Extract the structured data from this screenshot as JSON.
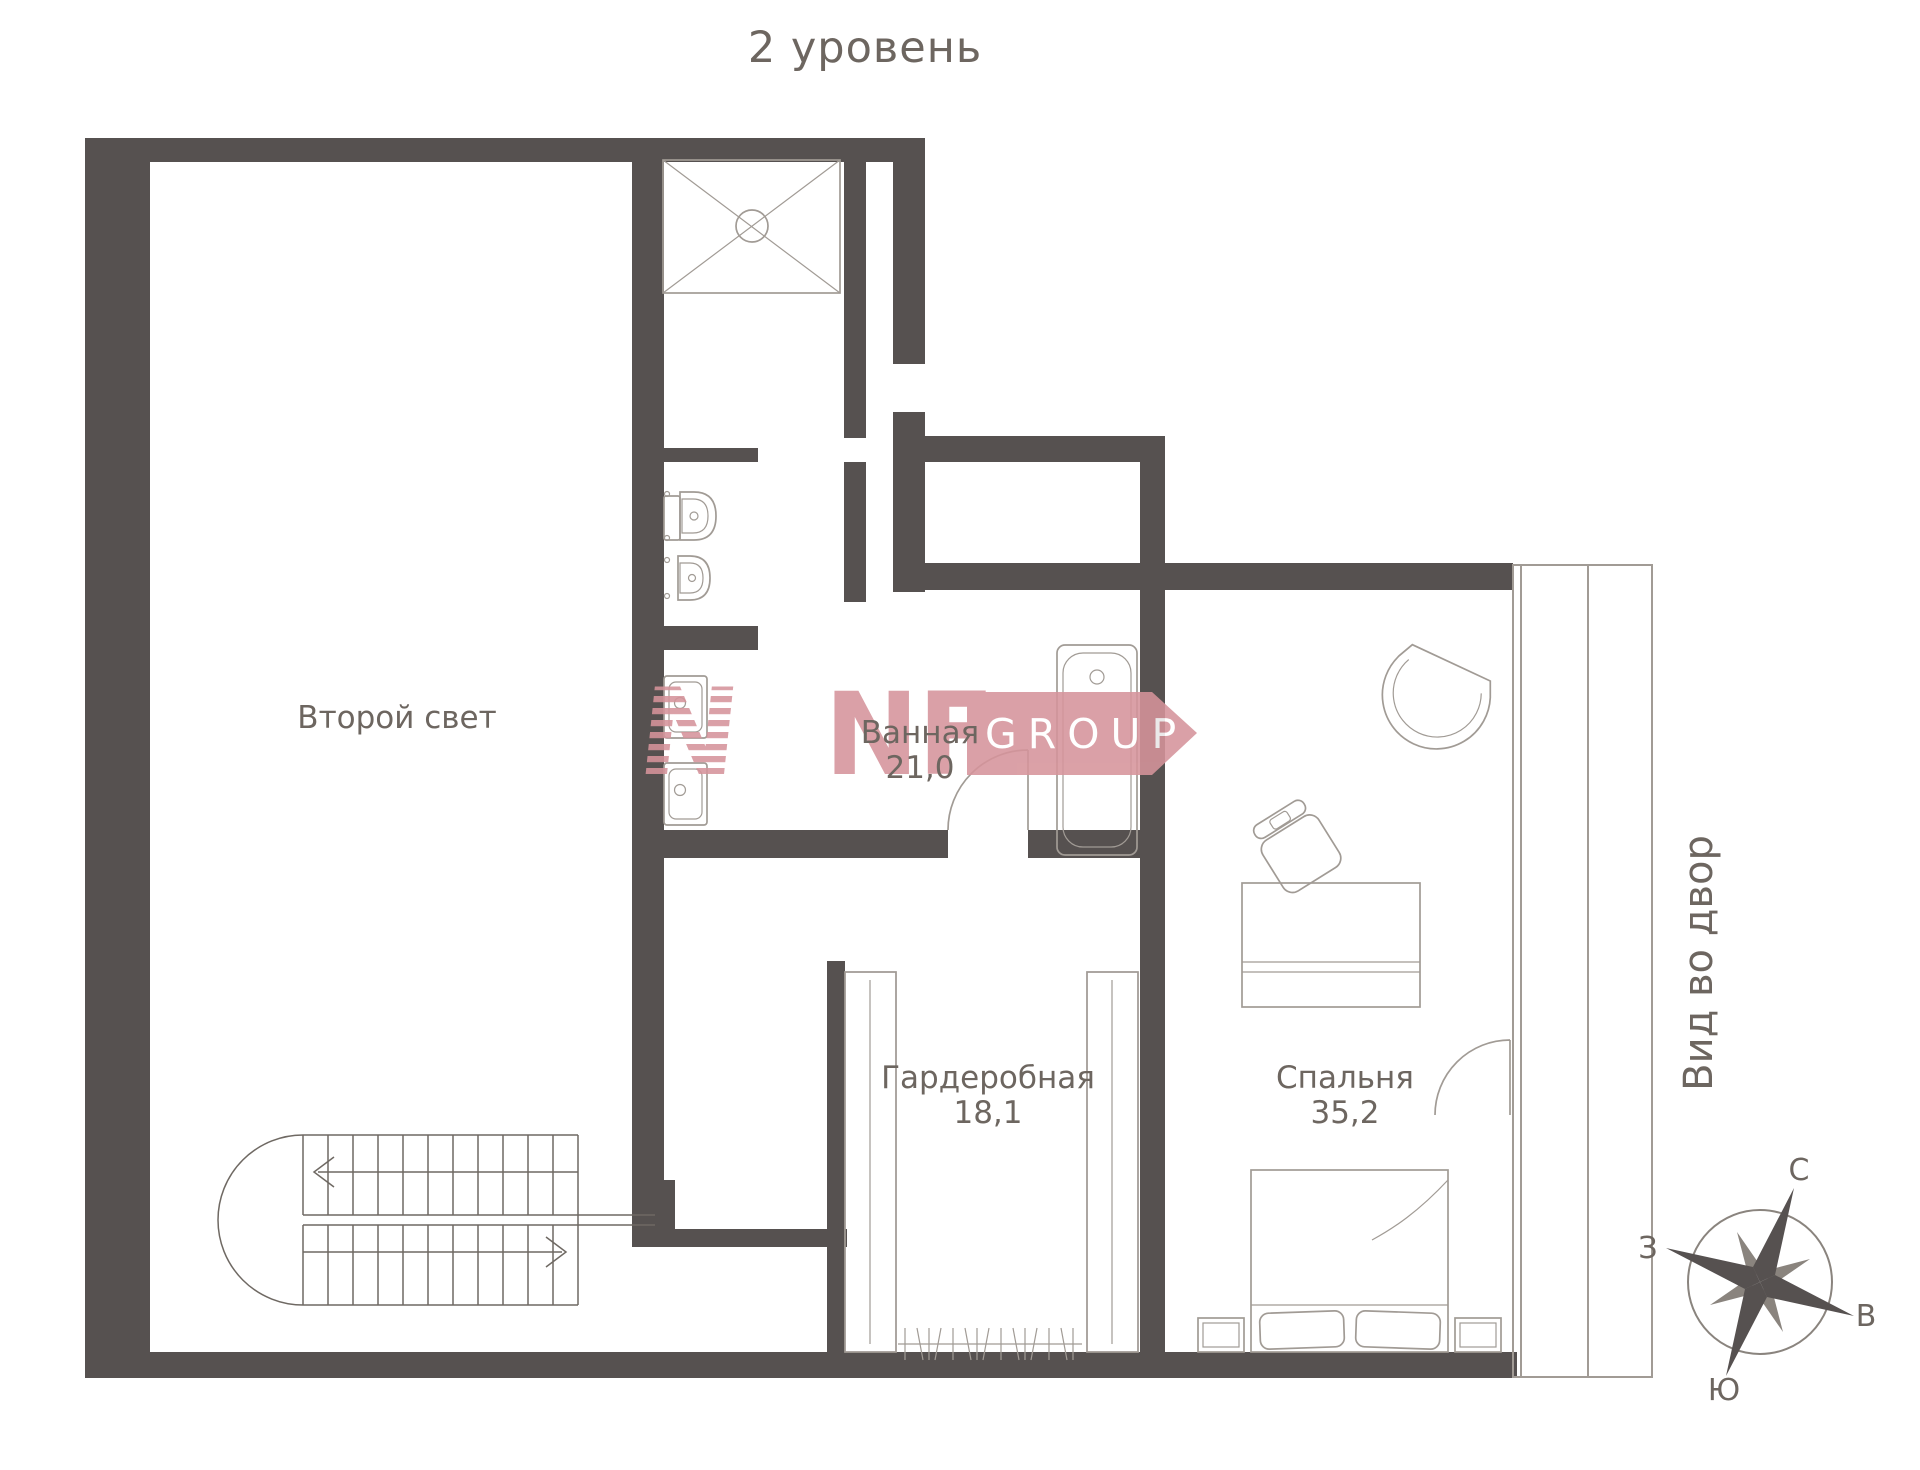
{
  "page": {
    "title": "2 уровень"
  },
  "rooms": {
    "second_light": {
      "label": "Второй свет"
    },
    "bathroom": {
      "label": "Ванная",
      "area": "21,0"
    },
    "wardrobe": {
      "label": "Гардеробная",
      "area": "18,1"
    },
    "bedroom": {
      "label": "Спальня",
      "area": "35,2"
    }
  },
  "annotations": {
    "view": "Вид во двор"
  },
  "compass": {
    "n": "С",
    "e": "В",
    "s": "Ю",
    "w": "З"
  },
  "logo": {
    "mark": "N",
    "nf": "NF",
    "group": "GROUP"
  },
  "colors": {
    "wall": "#565150",
    "line": "#a19b95",
    "text": "#6d6660",
    "stairs": "#6f6963",
    "hatch": "#b3ada7",
    "logo-pink": "#d6949b"
  }
}
